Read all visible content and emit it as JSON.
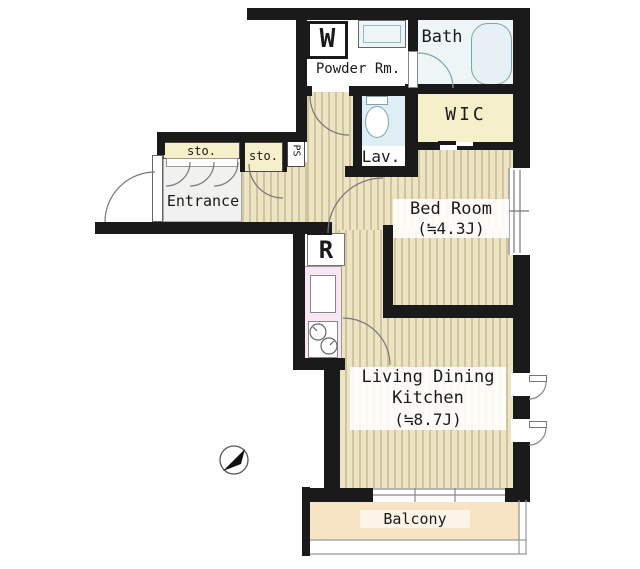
{
  "floorplan": {
    "rooms": {
      "powder_room": {
        "label": "Powder Rm."
      },
      "washing_machine": {
        "label": "W"
      },
      "bath": {
        "label": "Bath"
      },
      "wic": {
        "label": "WIC"
      },
      "lavatory": {
        "label": "Lav."
      },
      "bedroom": {
        "label": "Bed Room",
        "size": "(≒4.3J)"
      },
      "entrance": {
        "label": "Entrance"
      },
      "storage1": {
        "label": "sto."
      },
      "storage2": {
        "label": "sto."
      },
      "pipe_space": {
        "label": "PS"
      },
      "refrigerator": {
        "label": "R"
      },
      "ldk": {
        "label_line1": "Living Dining",
        "label_line2": "Kitchen",
        "size": "(≒8.7J)"
      },
      "balcony": {
        "label": "Balcony"
      }
    },
    "colors": {
      "wall": "#1a1a1a",
      "wood_floor_base": "#ece4c3",
      "wood_floor_stripe": "#cfc49d",
      "closet_cream": "#f6f0ca",
      "entrance_gray": "#f1f1ef",
      "kitchen_pink": "#f8e6f3",
      "water_blue": "#e8f2f6",
      "fixture_border": "#7fa2b0",
      "balcony_peach": "#f7e4c4"
    }
  }
}
